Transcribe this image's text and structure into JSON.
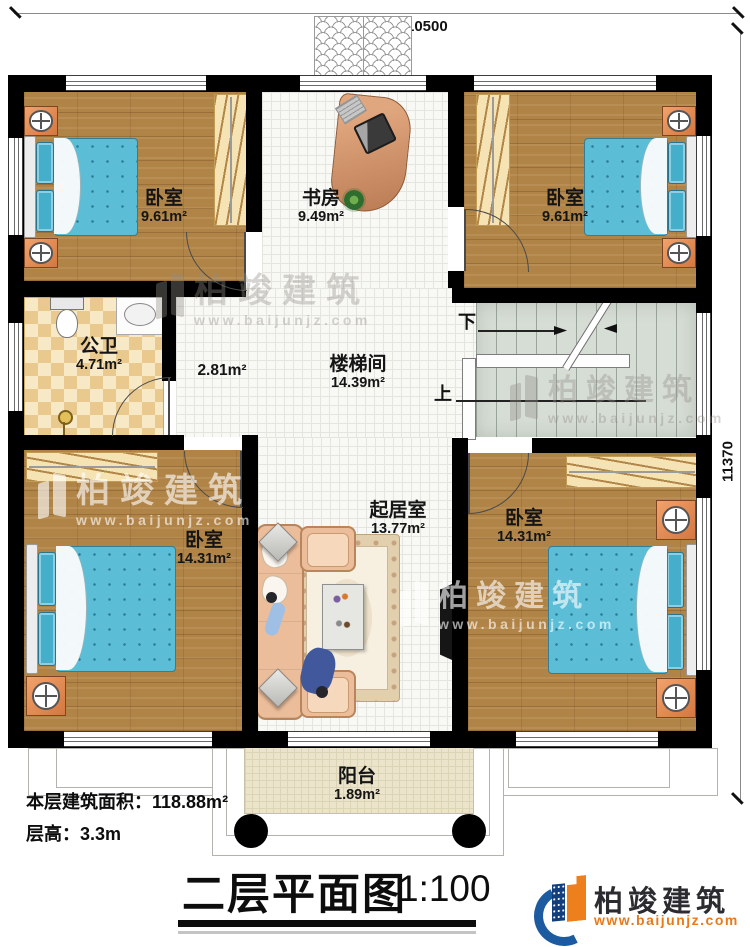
{
  "dimensions": {
    "top": "10500",
    "right": "11370"
  },
  "rooms": {
    "bedroom_tl": {
      "name": "卧室",
      "area": "9.61m²"
    },
    "study": {
      "name": "书房",
      "area": "9.49m²"
    },
    "bedroom_tr": {
      "name": "卧室",
      "area": "9.61m²"
    },
    "bathroom": {
      "name": "公卫",
      "area": "4.71m²"
    },
    "hallway": {
      "area": "2.81m²"
    },
    "stairwell": {
      "name": "楼梯间",
      "area": "14.39m²"
    },
    "bedroom_bl": {
      "name": "卧室",
      "area": "14.31m²"
    },
    "living_room": {
      "name": "起居室",
      "area": "13.77m²"
    },
    "bedroom_br": {
      "name": "卧室",
      "area": "14.31m²"
    },
    "balcony": {
      "name": "阳台",
      "area": "1.89m²"
    }
  },
  "stairs": {
    "down": "下",
    "up": "上"
  },
  "footer": {
    "area_info": "本层建筑面积：118.88m²",
    "floor_height_info": "层高：3.3m",
    "title": "二层平面图",
    "scale": "1:100"
  },
  "brand": {
    "name": "柏竣建筑",
    "website": "www.baijunjz.com"
  },
  "watermark": {
    "name": "柏竣建筑",
    "website": "www.baijunjz.com"
  },
  "colors": {
    "wall": "#000000",
    "wood_floor": "#b08347",
    "tile_floor": "#f8f8f5",
    "bath_checker": "#e9c98e",
    "stair_floor": "#d6ddd5",
    "balcony_floor": "#ece4ca",
    "bed_blue": "#5bbdd6",
    "sofa_peach": "#ecbd9a",
    "brand_blue": "#1d5ba0",
    "brand_orange": "#ee7f1d"
  }
}
